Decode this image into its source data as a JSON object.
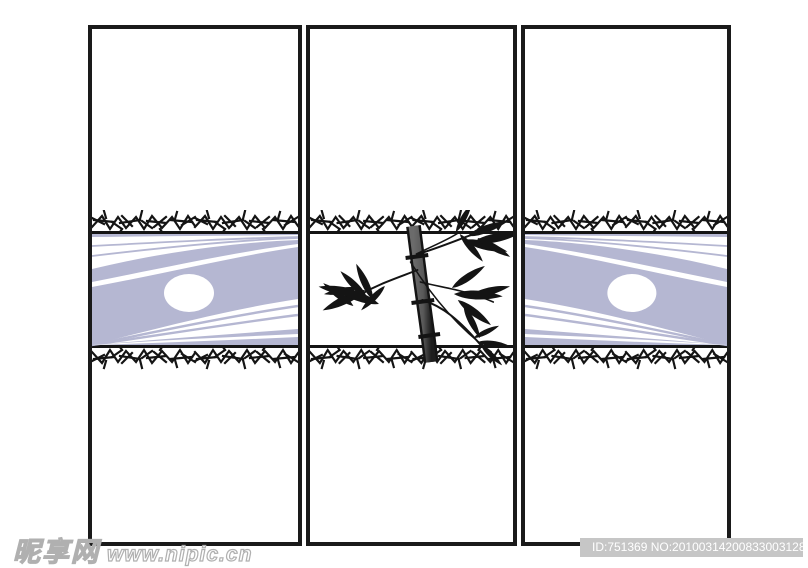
{
  "artwork": {
    "title": "Three-panel sliding-door glass design with bamboo and ray-band motif",
    "panels": [
      {
        "name": "left-door",
        "motif": "lavender ray band with white ellipse, crackle borders"
      },
      {
        "name": "center-door",
        "motif": "black ink bamboo stalk with leaves, crackle borders"
      },
      {
        "name": "right-door",
        "motif": "mirrored lavender ray band with white ellipse, crackle borders"
      }
    ]
  },
  "watermarks": {
    "site": {
      "logo_text": "昵享网",
      "url_text": "www.nipic.cn"
    },
    "id_bar": {
      "text": "ID:751369 NO:20100314200833003128"
    }
  },
  "theme": {
    "colors": {
      "page-bg": "#ffffff",
      "panel-border": "#1a1a1a",
      "ink": "#141414",
      "lavender": "#b5b7d2",
      "stem-light": "#6b6b6b",
      "stem-dark": "#1d1d1d",
      "wm-bar": "#c6c6c6",
      "wm-text": "#ffffff",
      "wm-outline": "#b0b0b0"
    }
  }
}
